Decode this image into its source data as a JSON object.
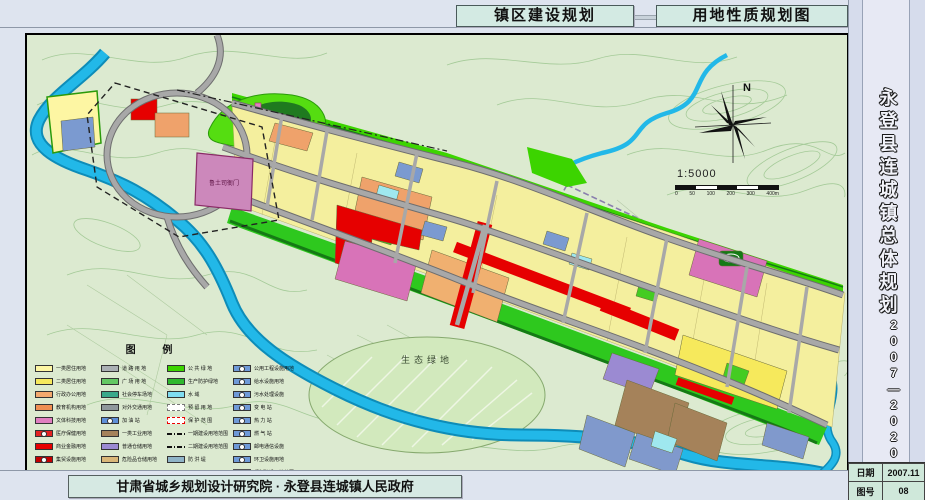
{
  "header": {
    "title_left": "镇区建设规划",
    "title_right": "用地性质规划图"
  },
  "sidebar": {
    "title_vertical": "永登县连城镇总体规划",
    "years": "2007—2020"
  },
  "title_block": {
    "date_label": "日期",
    "date_value": "2007.11",
    "sheet_label": "图号",
    "sheet_value": "08"
  },
  "footer": {
    "credit": "甘肃省城乡规划设计研究院 · 永登县连城镇人民政府"
  },
  "map": {
    "north_label": "N",
    "scale_text": "1:5000",
    "scale_ticks": [
      "0",
      "50",
      "100",
      "200",
      "300",
      "400m"
    ],
    "labels": {
      "heritage": "鲁土司衙门",
      "eco_green": "生态绿地"
    }
  },
  "legend": {
    "title": "图    例",
    "columns": [
      [
        {
          "label": "一类居住用地",
          "color": "#fdf6a3",
          "style": "fill"
        },
        {
          "label": "二类居住用地",
          "color": "#f6e95c",
          "style": "fill"
        },
        {
          "label": "行政办公用地",
          "color": "#f3a96e",
          "style": "fill"
        },
        {
          "label": "教育机构用地",
          "color": "#ef8f52",
          "style": "fill"
        },
        {
          "label": "文体科技用地",
          "color": "#e07fc0",
          "style": "fill"
        },
        {
          "label": "医疗保健用地",
          "color": "#e32222",
          "style": "fill-dot"
        },
        {
          "label": "商业金融用地",
          "color": "#e60000",
          "style": "fill"
        },
        {
          "label": "集贸设施用地",
          "color": "#c40000",
          "style": "fill-dot"
        }
      ],
      [
        {
          "label": "道 路 用 地",
          "color": "#aab0b4",
          "style": "fill"
        },
        {
          "label": "广 场 用 地",
          "color": "#63c863",
          "style": "fill"
        },
        {
          "label": "社会停车场地",
          "color": "#3aa98a",
          "style": "fill"
        },
        {
          "label": "对外交通用地",
          "color": "#8f979c",
          "style": "fill"
        },
        {
          "label": "加 油 站",
          "color": "#5f8fd8",
          "style": "fill-dot"
        },
        {
          "label": "一类工业用地",
          "color": "#a5825a",
          "style": "fill"
        },
        {
          "label": "普通仓储用地",
          "color": "#9b8ad2",
          "style": "fill"
        },
        {
          "label": "危险品仓储用地",
          "color": "#d9b679",
          "style": "fill"
        }
      ],
      [
        {
          "label": "公 共 绿 地",
          "color": "#3cd400",
          "style": "fill"
        },
        {
          "label": "生产防护绿地",
          "color": "#2eb82e",
          "style": "fill"
        },
        {
          "label": "水    域",
          "color": "#7fdcf0",
          "style": "fill"
        },
        {
          "label": "预 留 用 地",
          "color": "#ffffff",
          "style": "dash-border"
        },
        {
          "label": "保 护 范 围",
          "color": "#ffffff",
          "style": "dash-red"
        },
        {
          "label": "一期建设用地范围",
          "color": "",
          "style": "line"
        },
        {
          "label": "二期建设用地范围",
          "color": "",
          "style": "line"
        },
        {
          "label": "防 洪 堤",
          "color": "#8fb4c8",
          "style": "fill"
        }
      ],
      [
        {
          "label": "公用工程设施用地",
          "color": "#6f9ad8",
          "style": "fill-dot"
        },
        {
          "label": "给水设施用地",
          "color": "#6f9ad8",
          "style": "fill-dot"
        },
        {
          "label": "污水处理设施",
          "color": "#6f9ad8",
          "style": "fill-dot"
        },
        {
          "label": "变  电  站",
          "color": "#6f9ad8",
          "style": "fill-dot"
        },
        {
          "label": "热  力  站",
          "color": "#6f9ad8",
          "style": "fill-dot"
        },
        {
          "label": "燃  气  站",
          "color": "#6f9ad8",
          "style": "fill-dot"
        },
        {
          "label": "邮电通信设施",
          "color": "#6f9ad8",
          "style": "fill-dot"
        },
        {
          "label": "环卫设施用地",
          "color": "#6f9ad8",
          "style": "fill-dot"
        },
        {
          "label": "规划建设用地范围",
          "color": "#f2f5f0",
          "style": "outline"
        }
      ]
    ]
  },
  "palette": {
    "page_bg": "#dee4ef",
    "map_bg": "#dcead0",
    "contour": "#9fc792",
    "river": "#22b8e8",
    "road": "#9c9c9c",
    "residential_1": "#fdf6a3",
    "residential_2": "#f6e95c",
    "commercial_red": "#e60000",
    "culture_pink": "#d873b8",
    "education_orange": "#efa26b",
    "industry_brown": "#a5825a",
    "storage_purple": "#9b8ad2",
    "utility_blue": "#7b9ad0",
    "medical_cyan": "#9fe8ef",
    "green_space": "#3cd400",
    "forest_dark": "#1f7a1f"
  }
}
